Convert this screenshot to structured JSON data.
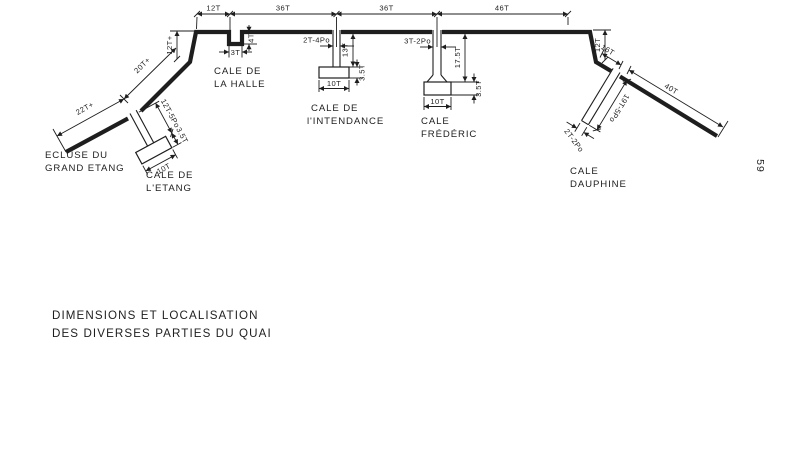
{
  "page": {
    "number": "59"
  },
  "title": {
    "line1": "DIMENSIONS ET LOCALISATION",
    "line2": "DES DIVERSES PARTIES DU QUAI"
  },
  "labels": {
    "ecluse_grand_etang": {
      "line1": "ECLUSE DU",
      "line2": "GRAND ETANG"
    },
    "cale_de_letang": {
      "line1": "CALE DE",
      "line2": "L'ETANG"
    },
    "cale_de_la_halle": {
      "line1": "CALE DE",
      "line2": "LA HALLE"
    },
    "cale_de_lintendance": {
      "line1": "CALE DE",
      "line2": "l'INTENDANCE"
    },
    "cale_frederic": {
      "line1": "CALE",
      "line2": "FRÉDÉRIC"
    },
    "cale_dauphine": {
      "line1": "CALE",
      "line2": "DAUPHINE"
    }
  },
  "dimensions": {
    "top": {
      "d1": "12T",
      "d2": "36T",
      "d3": "36T",
      "d4": "46T"
    },
    "left_quay": {
      "d12": "12T+",
      "d20": "20T+",
      "d22": "22T+"
    },
    "halle_notch": {
      "width": "3T",
      "depth": "4T"
    },
    "intendance": {
      "pier_width": "2T-4Po",
      "length": "13T",
      "base_height": "3.5T",
      "base_width": "10T"
    },
    "frederic": {
      "pier_width": "3T-2Po",
      "length": "17.5T",
      "base_height": "3.5T",
      "base_width": "10T"
    },
    "etang": {
      "length": "12T-5Po",
      "base_height": "3.5T",
      "base_width": "10T"
    },
    "right_quay": {
      "d12": "12T",
      "d16": "16T",
      "d40": "40T"
    },
    "dauphine": {
      "length": "19T-5Po",
      "pier_width": "2T-2Po"
    }
  },
  "colors": {
    "ink": "#1e1e1e",
    "paper": "#ffffff"
  }
}
